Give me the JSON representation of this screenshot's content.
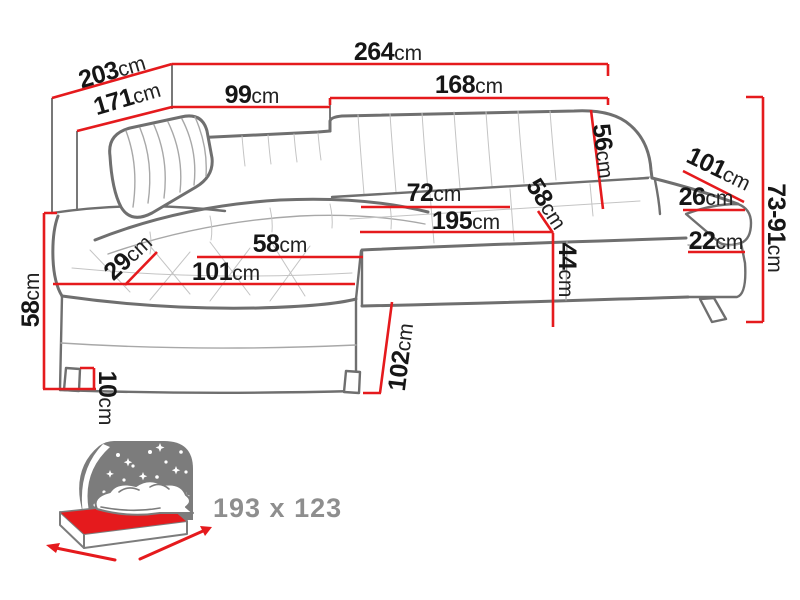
{
  "diagram": {
    "title": "corner-sofa-dimension-diagram",
    "dimensions": [
      {
        "id": "total-width",
        "value": "264",
        "unit": "cm"
      },
      {
        "id": "total-depth",
        "value": "203",
        "unit": "cm"
      },
      {
        "id": "inner-depth",
        "value": "171",
        "unit": "cm"
      },
      {
        "id": "back-left-width",
        "value": "99",
        "unit": "cm"
      },
      {
        "id": "back-right-width",
        "value": "168",
        "unit": "cm"
      },
      {
        "id": "backrest-height",
        "value": "56",
        "unit": "cm"
      },
      {
        "id": "armrest-length",
        "value": "101",
        "unit": "cm"
      },
      {
        "id": "armrest-width",
        "value": "26",
        "unit": "cm"
      },
      {
        "id": "height-range",
        "value": "73-91",
        "unit": "cm"
      },
      {
        "id": "seat-back-width",
        "value": "72",
        "unit": "cm"
      },
      {
        "id": "seat-depth",
        "value": "58",
        "unit": "cm"
      },
      {
        "id": "seat-length",
        "value": "195",
        "unit": "cm"
      },
      {
        "id": "front-edge-height",
        "value": "22",
        "unit": "cm"
      },
      {
        "id": "seat-height",
        "value": "44",
        "unit": "cm"
      },
      {
        "id": "chaise-bolster",
        "value": "29",
        "unit": "cm"
      },
      {
        "id": "chaise-seat-width",
        "value": "58",
        "unit": "cm"
      },
      {
        "id": "chaise-seat-length",
        "value": "101",
        "unit": "cm"
      },
      {
        "id": "side-height",
        "value": "58",
        "unit": "cm"
      },
      {
        "id": "leg-height",
        "value": "10",
        "unit": "cm"
      },
      {
        "id": "chaise-depth",
        "value": "102",
        "unit": "cm"
      }
    ],
    "sleeping_function": {
      "bed_size_label": "193 x 123",
      "icon": "sleeping-function-bed-icon"
    },
    "colors": {
      "dimension_red": "#e51a1d",
      "sofa_outline_gray": "#6f6f6f",
      "icon_gray": "#7c7c7c",
      "icon_text_gray": "#8e8e8e",
      "label_black": "#161616",
      "background": "#ffffff"
    }
  }
}
